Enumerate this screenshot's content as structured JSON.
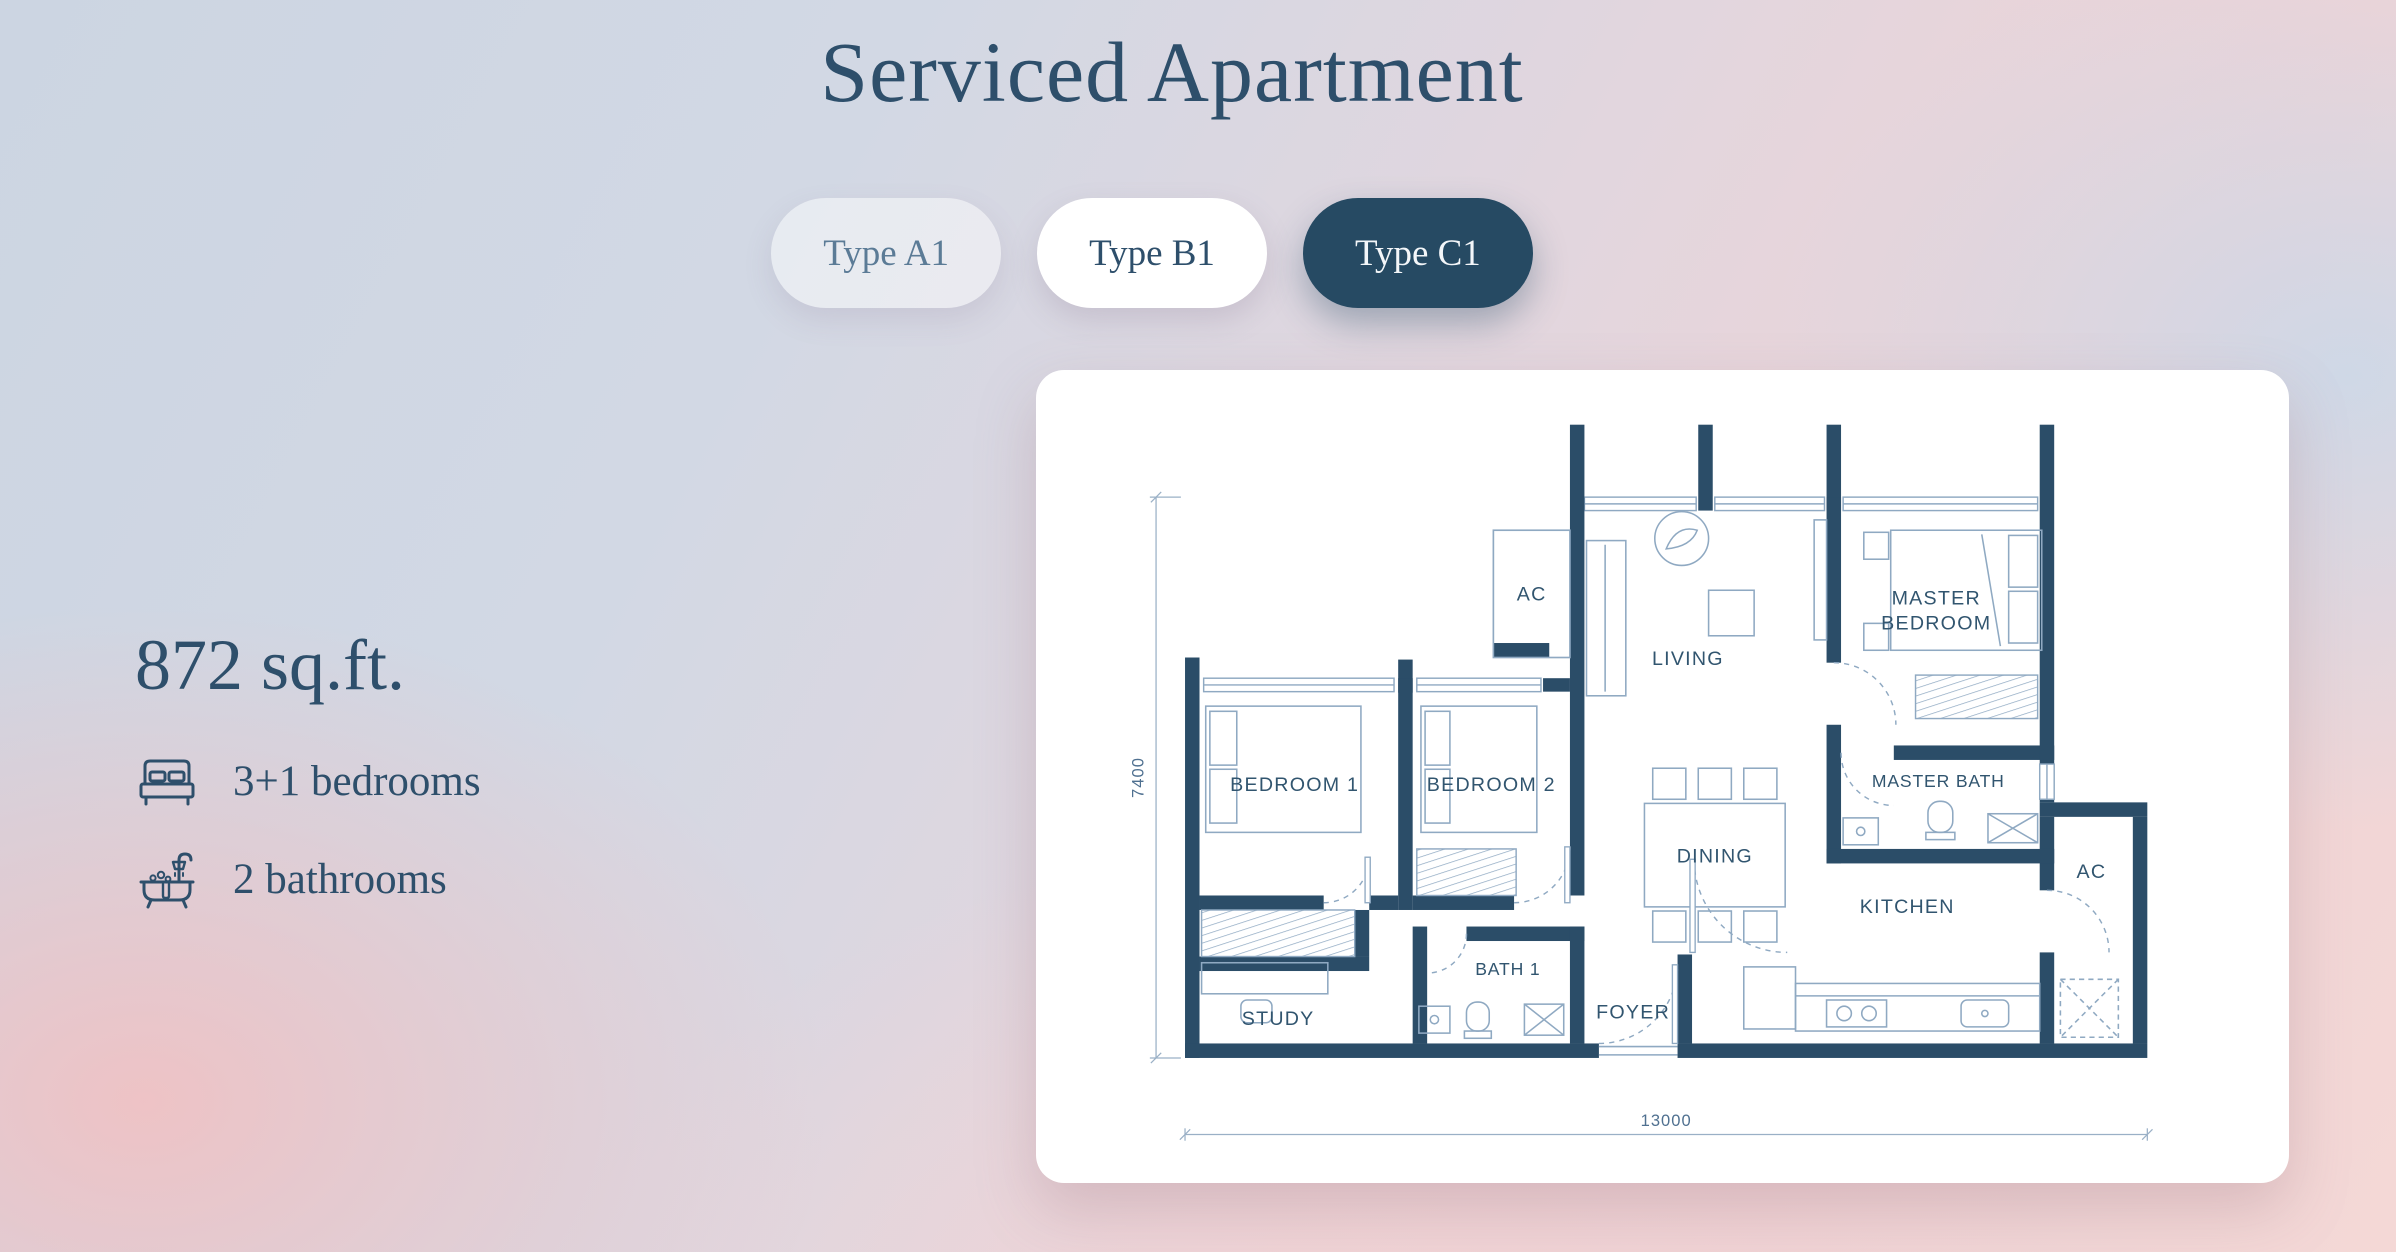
{
  "page": {
    "title": "Serviced Apartment"
  },
  "tabs": [
    {
      "id": "type-a1",
      "label": "Type A1",
      "active": false
    },
    {
      "id": "type-b1",
      "label": "Type B1",
      "active": false
    },
    {
      "id": "type-c1",
      "label": "Type C1",
      "active": true
    }
  ],
  "unit": {
    "area": "872 sq.ft.",
    "bedrooms": "3+1 bedrooms",
    "bathrooms": "2 bathrooms"
  },
  "floorplan": {
    "labels": {
      "bedroom1": "BEDROOM 1",
      "bedroom2": "BEDROOM 2",
      "ac_upper": "AC",
      "living": "LIVING",
      "master_bedroom_line1": "MASTER",
      "master_bedroom_line2": "BEDROOM",
      "dining": "DINING",
      "master_bath": "MASTER BATH",
      "kitchen": "KITCHEN",
      "ac_lower": "AC",
      "study": "STUDY",
      "bath1": "BATH 1",
      "foyer": "FOYER"
    },
    "dimensions": {
      "width_mm": "13000",
      "depth_mm": "7400"
    },
    "colors": {
      "wall": "#2b4d68",
      "furniture_line": "#8fa9c2",
      "label_text": "#31556f"
    }
  },
  "colors": {
    "accent_navy": "#264a63",
    "heading_text": "#2e4f6b",
    "card_background": "#ffffff",
    "background_blue": "#ccd5e2",
    "background_pink": "#f3bfc0"
  }
}
